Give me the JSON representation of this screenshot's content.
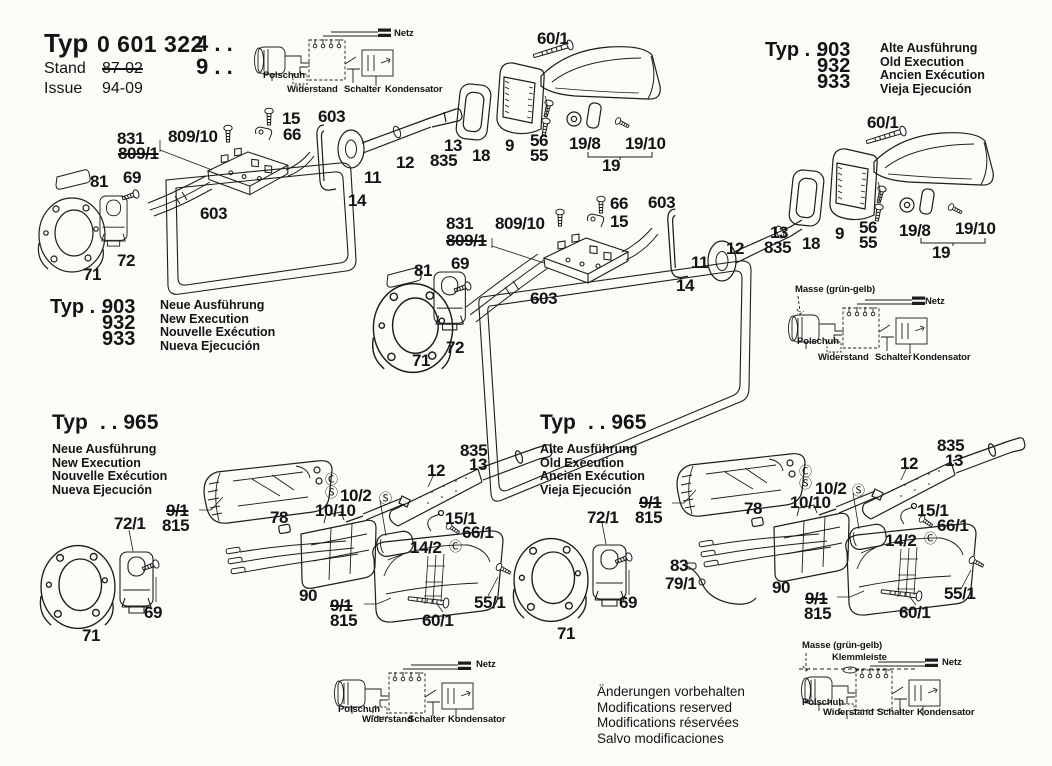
{
  "header": {
    "typ_label": "Typ",
    "typ_value": "0 601 322",
    "suffix_line1": "4 . .",
    "suffix_line2": "9 . .",
    "stand_label": "Stand",
    "stand_value": "87-02",
    "issue_label": "Issue",
    "issue_value": "94-09"
  },
  "type_blocks": {
    "top_right": {
      "typ": "Typ . .",
      "codes": [
        "903",
        "932",
        "933"
      ],
      "lines": [
        "Alte Ausführung",
        "Old Execution",
        "Ancien Exécution",
        "Vieja Ejecución"
      ]
    },
    "mid_left": {
      "typ": "Typ . .",
      "codes": [
        "903",
        "932",
        "933"
      ],
      "lines": [
        "Neue Ausführung",
        "New Execution",
        "Nouvelle Exécution",
        "Nueva Ejecución"
      ]
    },
    "bottom_left": {
      "typ": "Typ",
      "code": ". . 965",
      "lines": [
        "Neue Ausführung",
        "New Execution",
        "Nouvelle Exécution",
        "Nueva Ejecución"
      ]
    },
    "bottom_right": {
      "typ": "Typ",
      "code": ". . 965",
      "lines": [
        "Alte Ausführung",
        "Old Execution",
        "Ancien Exécution",
        "Vieja Ejecución"
      ]
    }
  },
  "footer_notes": [
    "Änderungen vorbehalten",
    "Modifications reserved",
    "Modifications réservées",
    "Salvo modificaciones"
  ],
  "figures": [
    {
      "name": "exploded-view-top-new-execution",
      "labels": [
        {
          "t": "831",
          "x": 117,
          "y": 130
        },
        {
          "t": "809/10",
          "x": 168,
          "y": 128
        },
        {
          "t": "809/1",
          "x": 118,
          "y": 145,
          "c": "strike"
        },
        {
          "t": "15",
          "x": 282,
          "y": 110
        },
        {
          "t": "66",
          "x": 283,
          "y": 126
        },
        {
          "t": "603",
          "x": 318,
          "y": 108
        },
        {
          "t": "81",
          "x": 90,
          "y": 173
        },
        {
          "t": "69",
          "x": 123,
          "y": 169
        },
        {
          "t": "603",
          "x": 200,
          "y": 205
        },
        {
          "t": "72",
          "x": 117,
          "y": 252
        },
        {
          "t": "71",
          "x": 83,
          "y": 266
        },
        {
          "t": "11",
          "x": 364,
          "y": 169
        },
        {
          "t": "14",
          "x": 348,
          "y": 192
        },
        {
          "t": "12",
          "x": 396,
          "y": 154
        },
        {
          "t": "13",
          "x": 444,
          "y": 137
        },
        {
          "t": "835",
          "x": 430,
          "y": 152
        },
        {
          "t": "18",
          "x": 472,
          "y": 147
        },
        {
          "t": "9",
          "x": 505,
          "y": 137
        },
        {
          "t": "56",
          "x": 530,
          "y": 132
        },
        {
          "t": "55",
          "x": 530,
          "y": 147
        },
        {
          "t": "19/8",
          "x": 569,
          "y": 135
        },
        {
          "t": "19/10",
          "x": 625,
          "y": 135
        },
        {
          "t": "19",
          "x": 602,
          "y": 157
        },
        {
          "t": "60/1",
          "x": 537,
          "y": 30
        }
      ]
    },
    {
      "name": "exploded-view-right-old-execution",
      "labels": [
        {
          "t": "831",
          "x": 446,
          "y": 215
        },
        {
          "t": "809/10",
          "x": 495,
          "y": 215
        },
        {
          "t": "809/1",
          "x": 446,
          "y": 232,
          "c": "strike"
        },
        {
          "t": "66",
          "x": 610,
          "y": 195
        },
        {
          "t": "15",
          "x": 610,
          "y": 213
        },
        {
          "t": "81",
          "x": 414,
          "y": 262
        },
        {
          "t": "69",
          "x": 451,
          "y": 255
        },
        {
          "t": "603",
          "x": 530,
          "y": 290
        },
        {
          "t": "72",
          "x": 446,
          "y": 339
        },
        {
          "t": "71",
          "x": 412,
          "y": 352
        },
        {
          "t": "60/1",
          "x": 867,
          "y": 114
        },
        {
          "t": "603",
          "x": 648,
          "y": 194
        },
        {
          "t": "11",
          "x": 691,
          "y": 254
        },
        {
          "t": "14",
          "x": 676,
          "y": 277
        },
        {
          "t": "12",
          "x": 726,
          "y": 240
        },
        {
          "t": "13",
          "x": 770,
          "y": 224
        },
        {
          "t": "835",
          "x": 764,
          "y": 239
        },
        {
          "t": "18",
          "x": 802,
          "y": 235
        },
        {
          "t": "9",
          "x": 835,
          "y": 225
        },
        {
          "t": "56",
          "x": 859,
          "y": 219
        },
        {
          "t": "55",
          "x": 859,
          "y": 234
        },
        {
          "t": "19/8",
          "x": 899,
          "y": 222
        },
        {
          "t": "19/10",
          "x": 955,
          "y": 220
        },
        {
          "t": "19",
          "x": 932,
          "y": 244
        }
      ]
    },
    {
      "name": "exploded-view-bottom-left-new-965",
      "labels": [
        {
          "t": "72/1",
          "x": 114,
          "y": 515
        },
        {
          "t": "9/1",
          "x": 166,
          "y": 502,
          "c": "strike"
        },
        {
          "t": "815",
          "x": 162,
          "y": 517
        },
        {
          "t": "78",
          "x": 270,
          "y": 509
        },
        {
          "t": "10/10",
          "x": 315,
          "y": 502
        },
        {
          "t": "10/2",
          "x": 340,
          "y": 487
        },
        {
          "t": "Ⓢ",
          "x": 379,
          "y": 492,
          "c": "sym"
        },
        {
          "t": "Ⓒ",
          "x": 325,
          "y": 473,
          "c": "sym"
        },
        {
          "t": "Ⓢ",
          "x": 325,
          "y": 486,
          "c": "sym"
        },
        {
          "t": "12",
          "x": 427,
          "y": 462
        },
        {
          "t": "835",
          "x": 460,
          "y": 442
        },
        {
          "t": "13",
          "x": 469,
          "y": 456
        },
        {
          "t": "15/1",
          "x": 445,
          "y": 510
        },
        {
          "t": "66/1",
          "x": 462,
          "y": 524
        },
        {
          "t": "14/2",
          "x": 410,
          "y": 539
        },
        {
          "t": "Ⓒ",
          "x": 449,
          "y": 540,
          "c": "sym"
        },
        {
          "t": "90",
          "x": 299,
          "y": 587
        },
        {
          "t": "9/1",
          "x": 330,
          "y": 597,
          "c": "strike"
        },
        {
          "t": "815",
          "x": 330,
          "y": 612
        },
        {
          "t": "60/1",
          "x": 422,
          "y": 612
        },
        {
          "t": "55/1",
          "x": 474,
          "y": 594
        },
        {
          "t": "69",
          "x": 144,
          "y": 604
        },
        {
          "t": "71",
          "x": 82,
          "y": 627
        }
      ]
    },
    {
      "name": "exploded-view-bottom-right-old-965",
      "labels": [
        {
          "t": "72/1",
          "x": 587,
          "y": 509
        },
        {
          "t": "9/1",
          "x": 639,
          "y": 494,
          "c": "strike"
        },
        {
          "t": "815",
          "x": 635,
          "y": 509
        },
        {
          "t": "78",
          "x": 744,
          "y": 500
        },
        {
          "t": "10/10",
          "x": 790,
          "y": 494
        },
        {
          "t": "10/2",
          "x": 815,
          "y": 480
        },
        {
          "t": "Ⓢ",
          "x": 852,
          "y": 484,
          "c": "sym"
        },
        {
          "t": "Ⓒ",
          "x": 799,
          "y": 465,
          "c": "sym"
        },
        {
          "t": "Ⓢ",
          "x": 799,
          "y": 477,
          "c": "sym"
        },
        {
          "t": "12",
          "x": 900,
          "y": 455
        },
        {
          "t": "835",
          "x": 937,
          "y": 437
        },
        {
          "t": "13",
          "x": 945,
          "y": 452
        },
        {
          "t": "15/1",
          "x": 917,
          "y": 502
        },
        {
          "t": "66/1",
          "x": 937,
          "y": 517
        },
        {
          "t": "14/2",
          "x": 885,
          "y": 532
        },
        {
          "t": "Ⓒ",
          "x": 924,
          "y": 532,
          "c": "sym"
        },
        {
          "t": "83",
          "x": 670,
          "y": 557
        },
        {
          "t": "79/1",
          "x": 665,
          "y": 575
        },
        {
          "t": "90",
          "x": 772,
          "y": 579
        },
        {
          "t": "9/1",
          "x": 805,
          "y": 590,
          "c": "strike"
        },
        {
          "t": "815",
          "x": 804,
          "y": 605
        },
        {
          "t": "60/1",
          "x": 899,
          "y": 604
        },
        {
          "t": "55/1",
          "x": 944,
          "y": 585
        },
        {
          "t": "69",
          "x": 619,
          "y": 594
        },
        {
          "t": "71",
          "x": 557,
          "y": 625
        }
      ]
    }
  ],
  "schematics": [
    {
      "name": "wiring-schematic-top",
      "labels": [
        {
          "t": "Netz",
          "x": 394,
          "y": 29
        },
        {
          "t": "Polschuh",
          "x": 263,
          "y": 71
        },
        {
          "t": "Widerstand",
          "x": 287,
          "y": 85
        },
        {
          "t": "Schalter",
          "x": 344,
          "y": 85
        },
        {
          "t": "Kondensator",
          "x": 385,
          "y": 85
        }
      ]
    },
    {
      "name": "wiring-schematic-middle-right",
      "labels": [
        {
          "t": "Masse (grün-gelb)",
          "x": 795,
          "y": 285
        },
        {
          "t": "Netz",
          "x": 925,
          "y": 297
        },
        {
          "t": "Polschuh",
          "x": 797,
          "y": 337
        },
        {
          "t": "Widerstand",
          "x": 818,
          "y": 353
        },
        {
          "t": "Schalter",
          "x": 875,
          "y": 353
        },
        {
          "t": "Kondensator",
          "x": 913,
          "y": 353
        }
      ]
    },
    {
      "name": "wiring-schematic-bottom-center",
      "labels": [
        {
          "t": "Netz",
          "x": 476,
          "y": 660
        },
        {
          "t": "Polschuh",
          "x": 338,
          "y": 705
        },
        {
          "t": "Widerstand",
          "x": 362,
          "y": 715
        },
        {
          "t": "Schalter",
          "x": 408,
          "y": 715
        },
        {
          "t": "Kondensator",
          "x": 448,
          "y": 715
        }
      ]
    },
    {
      "name": "wiring-schematic-bottom-right",
      "labels": [
        {
          "t": "Masse (grün-gelb)",
          "x": 802,
          "y": 641
        },
        {
          "t": "Klemmleiste",
          "x": 832,
          "y": 653
        },
        {
          "t": "Netz",
          "x": 942,
          "y": 658
        },
        {
          "t": "Polschuh",
          "x": 802,
          "y": 698
        },
        {
          "t": "Widerstand",
          "x": 823,
          "y": 708
        },
        {
          "t": "Schalter",
          "x": 877,
          "y": 708
        },
        {
          "t": "Kondensator",
          "x": 917,
          "y": 708
        }
      ]
    }
  ]
}
